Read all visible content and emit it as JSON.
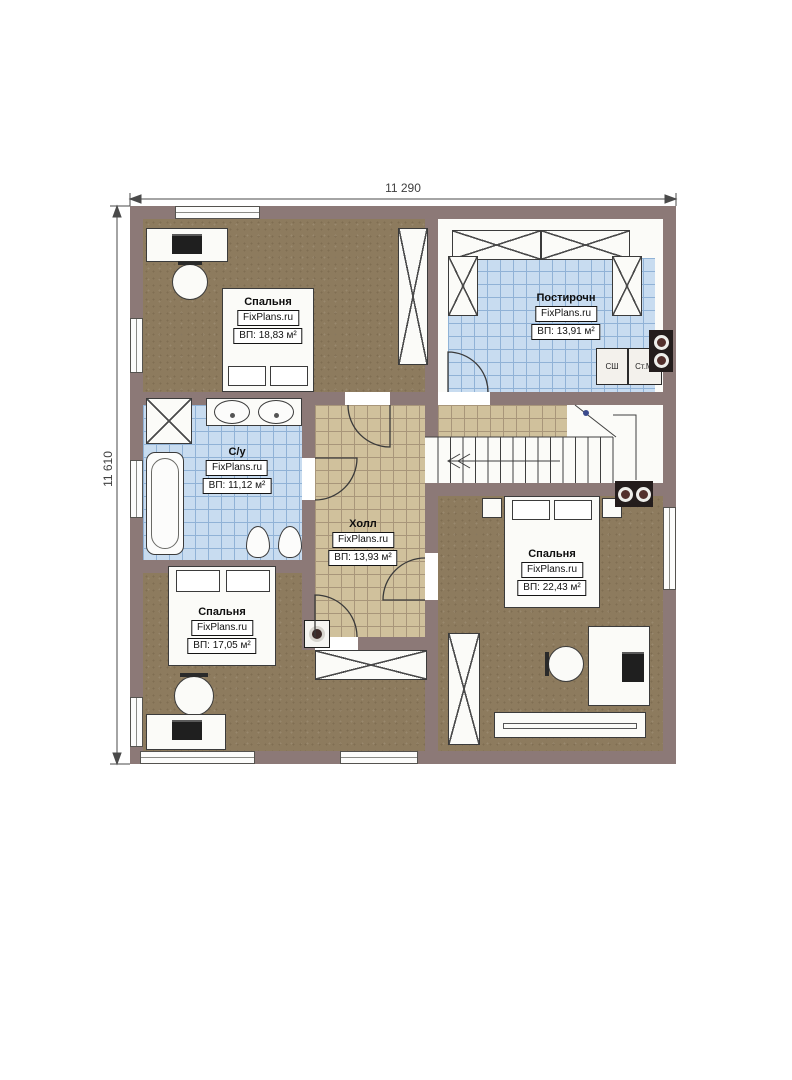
{
  "dimensions": {
    "top": "11 290",
    "left": "11 610"
  },
  "rooms": [
    {
      "id": "bedroom-top-left",
      "name": "Спальня",
      "brand": "FixPlans.ru",
      "area": "ВП: 18,83 м²"
    },
    {
      "id": "laundry",
      "name": "Постирочн",
      "brand": "FixPlans.ru",
      "area": "ВП: 13,91 м²"
    },
    {
      "id": "bathroom",
      "name": "С/у",
      "brand": "FixPlans.ru",
      "area": "ВП: 11,12 м²"
    },
    {
      "id": "hall",
      "name": "Холл",
      "brand": "FixPlans.ru",
      "area": "ВП: 13,93 м²"
    },
    {
      "id": "bedroom-right",
      "name": "Спальня",
      "brand": "FixPlans.ru",
      "area": "ВП: 22,43 м²"
    },
    {
      "id": "bedroom-bottom-left",
      "name": "Спальня",
      "brand": "FixPlans.ru",
      "area": "ВП: 17,05 м²"
    }
  ],
  "appliances": {
    "drying_cabinet": "СШ",
    "washing_machine": "Ст.М."
  },
  "colors": {
    "wall": "#8c7977",
    "bedroom_floor": "#8d7b5e",
    "tile_blue": "#c8dcf0",
    "tile_blue_line": "#90b2d6",
    "tile_tan": "#d0c19c",
    "tile_tan_line": "#a8967a",
    "furniture": "#fbfbf8",
    "outline": "#3b3b3b"
  }
}
